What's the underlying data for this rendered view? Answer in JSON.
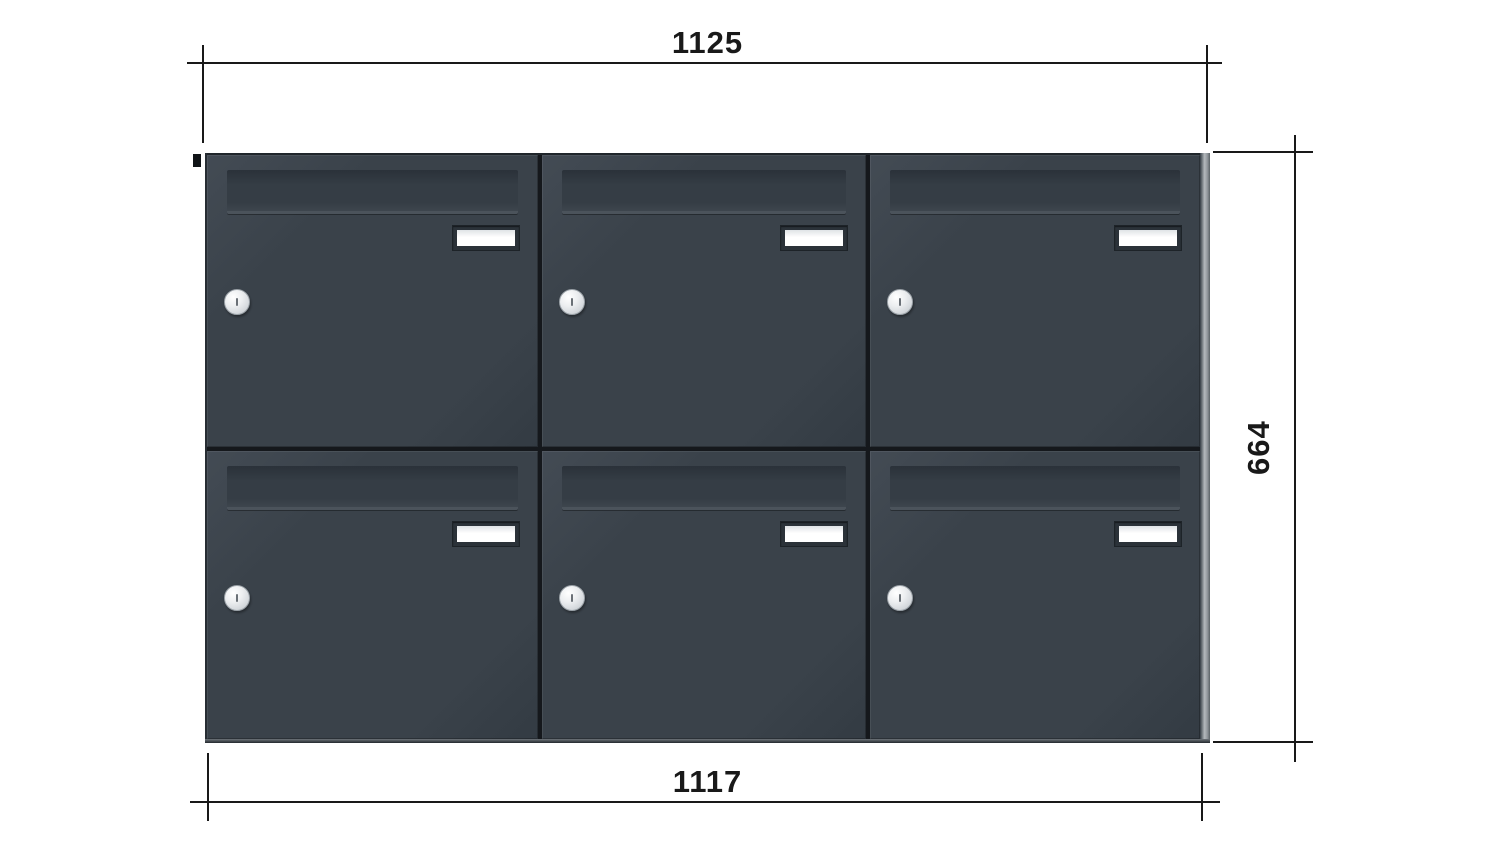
{
  "drawing": {
    "title": "letterbox-bank-front-elevation",
    "dimensions": {
      "top_width": {
        "value": "1125",
        "orientation": "horizontal",
        "position": "top"
      },
      "bottom_width": {
        "value": "1117",
        "orientation": "horizontal",
        "position": "bottom"
      },
      "right_height": {
        "value": "664",
        "orientation": "vertical",
        "position": "right"
      }
    },
    "unit": {
      "rows": 2,
      "columns": 3,
      "box_count": 6,
      "boxes": [
        {
          "id": "row1-col1",
          "features": [
            "mail-slot-flap",
            "name-plate",
            "lock-cylinder"
          ]
        },
        {
          "id": "row1-col2",
          "features": [
            "mail-slot-flap",
            "name-plate",
            "lock-cylinder"
          ]
        },
        {
          "id": "row1-col3",
          "features": [
            "mail-slot-flap",
            "name-plate",
            "lock-cylinder"
          ]
        },
        {
          "id": "row2-col1",
          "features": [
            "mail-slot-flap",
            "name-plate",
            "lock-cylinder"
          ]
        },
        {
          "id": "row2-col2",
          "features": [
            "mail-slot-flap",
            "name-plate",
            "lock-cylinder"
          ]
        },
        {
          "id": "row2-col3",
          "features": [
            "mail-slot-flap",
            "name-plate",
            "lock-cylinder"
          ]
        }
      ]
    },
    "colors": {
      "bg": "#ffffff",
      "door": "#3a424a",
      "door_hl": "#434b54",
      "door_dk": "#333b43",
      "gap": "#15181c",
      "flap": "#353d45",
      "flap_sh": "#2b323a",
      "flap_hl": "#4b535b",
      "plate": "#ffffff",
      "plate_frame": "#2b3239",
      "lock": "#d6dade",
      "lock_border": "#9aa1a7",
      "side_light": "#b4b9bd",
      "dim": "#191919"
    }
  }
}
